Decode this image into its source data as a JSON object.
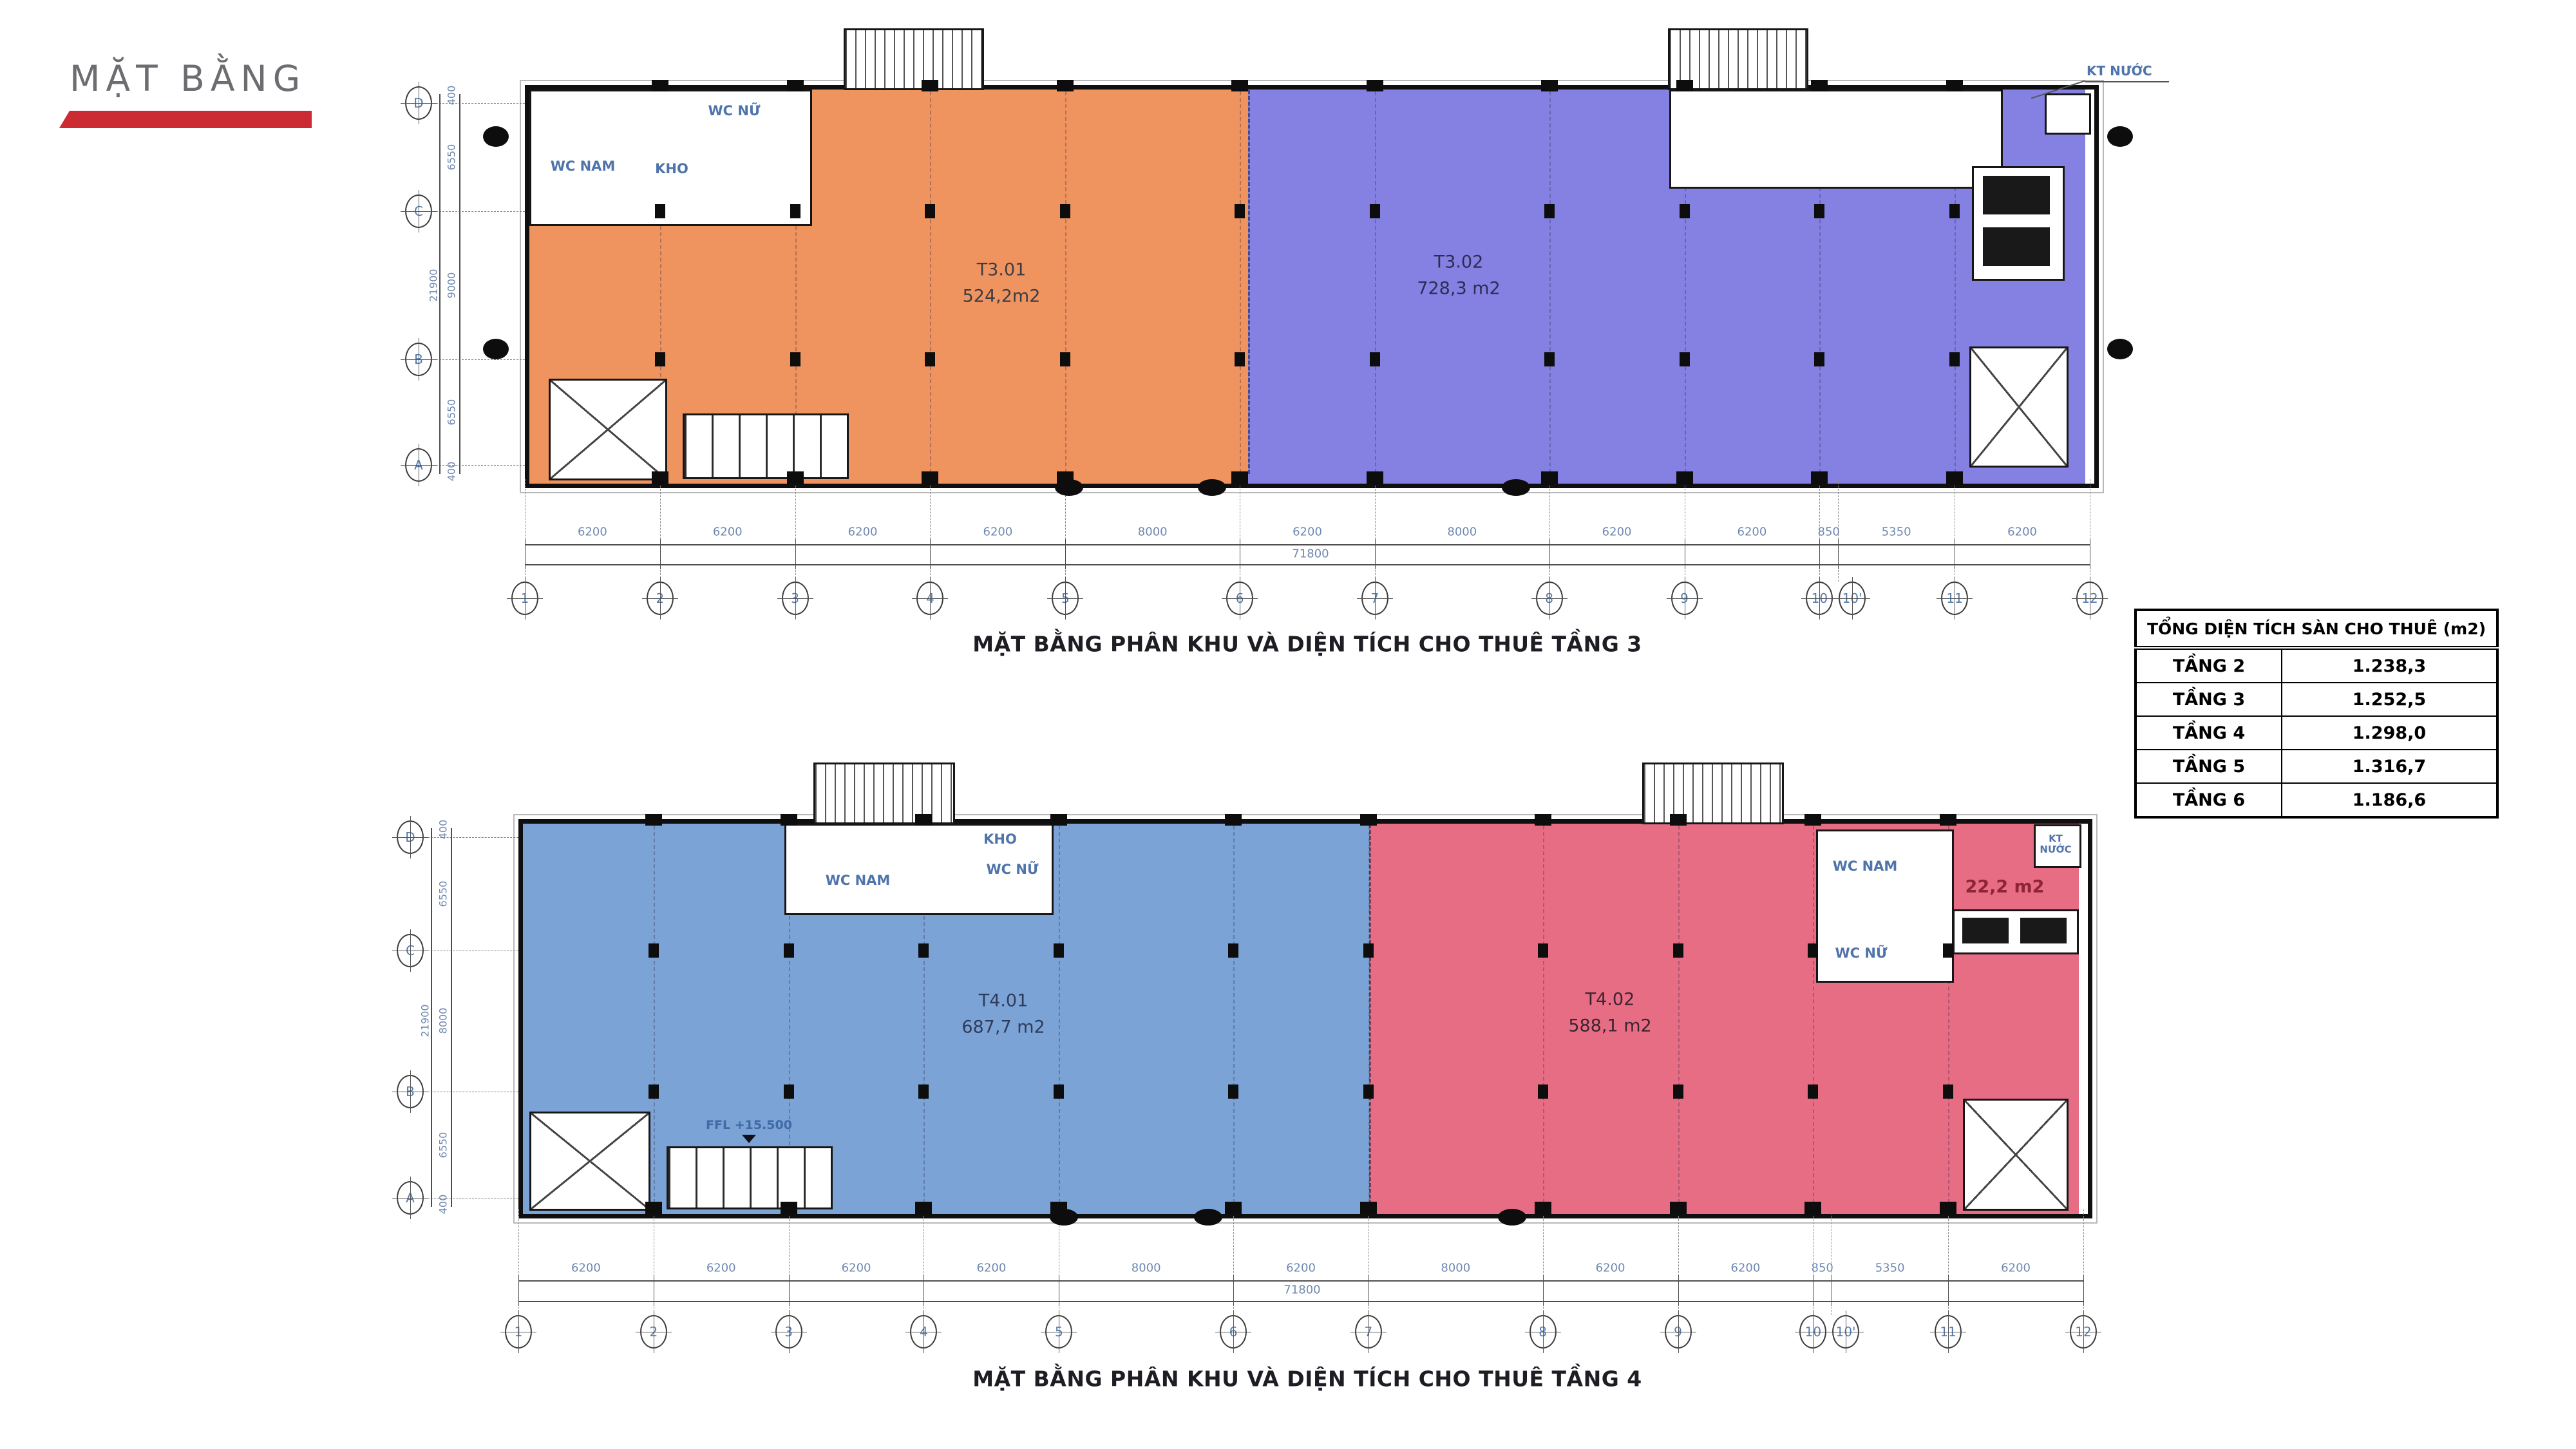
{
  "header": {
    "title": "MẶT BẰNG",
    "accent": "#cd2b34"
  },
  "summary_table": {
    "title": "TỔNG DIỆN TÍCH SÀN CHO THUÊ (m2)",
    "rows": [
      {
        "floor": "TẦNG 2",
        "area": "1.238,3"
      },
      {
        "floor": "TẦNG 3",
        "area": "1.252,5"
      },
      {
        "floor": "TẦNG 4",
        "area": "1.298,0"
      },
      {
        "floor": "TẦNG 5",
        "area": "1.316,7"
      },
      {
        "floor": "TẦNG 6",
        "area": "1.186,6"
      }
    ]
  },
  "plans": [
    {
      "caption": "MẶT BẰNG PHÂN KHU VÀ DIỆN TÍCH CHO THUÊ TẦNG 3",
      "zones": [
        {
          "code": "T3.01",
          "area": "524,2m2",
          "color": "#f0945f"
        },
        {
          "code": "T3.02",
          "area": "728,3 m2",
          "color": "#8481e3"
        }
      ],
      "grid_cols": [
        "1",
        "2",
        "3",
        "4",
        "5",
        "6",
        "7",
        "8",
        "9",
        "10",
        "10'",
        "11",
        "12"
      ],
      "span_labels": [
        "6200",
        "6200",
        "6200",
        "6200",
        "8000",
        "6200",
        "8000",
        "6200",
        "6200",
        "850",
        "5350",
        "6200"
      ],
      "total_label": "71800",
      "grid_rows": [
        "D",
        "C",
        "B",
        "A"
      ],
      "row_span_labels": [
        "400",
        "6550",
        "9000",
        "6550",
        "400"
      ],
      "row_total_label": "21900",
      "room_labels": [
        "WC NAM",
        "WC NỮ",
        "KHO"
      ],
      "annotation": "KT NƯỚC"
    },
    {
      "caption": "MẶT BẰNG PHÂN KHU VÀ DIỆN TÍCH CHO THUÊ TẦNG 4",
      "zones": [
        {
          "code": "T4.01",
          "area": "687,7 m2",
          "color": "#7ba3d6"
        },
        {
          "code": "T4.02",
          "area": "588,1 m2",
          "color": "#e76d84"
        }
      ],
      "grid_cols": [
        "1",
        "2",
        "3",
        "4",
        "5",
        "6",
        "7",
        "8",
        "9",
        "10",
        "10'",
        "11",
        "12"
      ],
      "span_labels": [
        "6200",
        "6200",
        "6200",
        "6200",
        "8000",
        "6200",
        "8000",
        "6200",
        "6200",
        "850",
        "5350",
        "6200"
      ],
      "total_label": "71800",
      "grid_rows": [
        "D",
        "C",
        "B",
        "A"
      ],
      "row_span_labels": [
        "400",
        "6550",
        "8000",
        "6550",
        "400"
      ],
      "row_total_label": "21900",
      "room_labels": [
        "WC NAM",
        "KHO",
        "WC NỮ",
        "WC NAM",
        "WC NỮ",
        "KT NƯỚC",
        "22,2 m2"
      ],
      "level_label": "FFL +15.500"
    }
  ]
}
